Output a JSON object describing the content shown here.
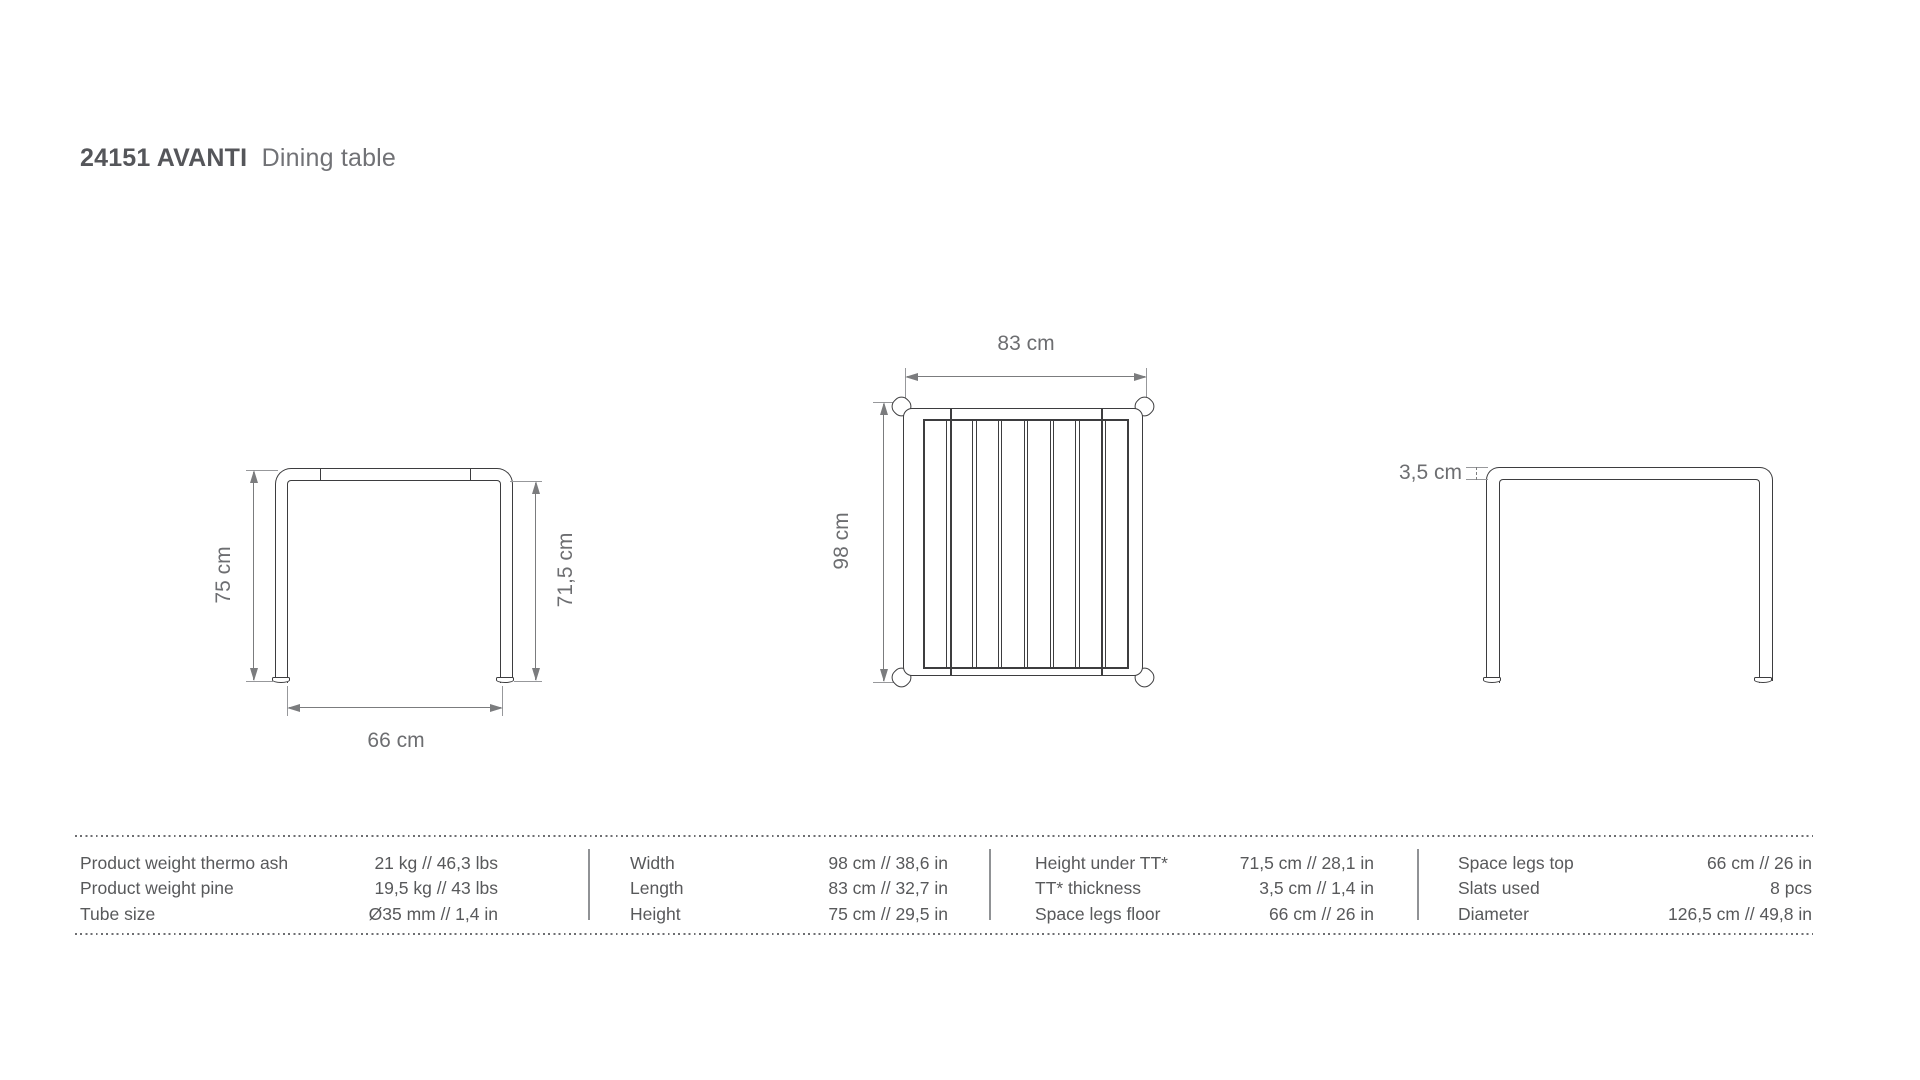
{
  "title": {
    "code": "24151 AVANTI",
    "product_type": "Dining table"
  },
  "drawings": {
    "front_view": {
      "name": "front view",
      "total_height_label": "75 cm",
      "height_under_top_label": "71,5 cm",
      "space_legs_label": "66 cm"
    },
    "top_view": {
      "name": "top view",
      "width_label": "83 cm",
      "length_label": "98 cm",
      "slat_count": 8
    },
    "side_view": {
      "name": "side view",
      "tabletop_thickness_label": "3,5 cm"
    }
  },
  "spec_table": {
    "columns": [
      {
        "rows": [
          {
            "label": "Product weight thermo ash",
            "value": "21 kg // 46,3 lbs"
          },
          {
            "label": "Product weight pine",
            "value": "19,5 kg // 43 lbs"
          },
          {
            "label": "Tube size",
            "value": "Ø35 mm // 1,4 in"
          }
        ]
      },
      {
        "rows": [
          {
            "label": "Width",
            "value": "98 cm // 38,6 in"
          },
          {
            "label": "Length",
            "value": "83 cm // 32,7 in"
          },
          {
            "label": "Height",
            "value": "75 cm // 29,5 in"
          }
        ]
      },
      {
        "rows": [
          {
            "label": "Height under TT*",
            "value": "71,5 cm // 28,1 in"
          },
          {
            "label": "TT* thickness",
            "value": "3,5 cm // 1,4 in"
          },
          {
            "label": "Space legs floor",
            "value": "66 cm // 26 in"
          }
        ]
      },
      {
        "rows": [
          {
            "label": "Space legs top",
            "value": "66 cm // 26 in"
          },
          {
            "label": "Slats used",
            "value": "8 pcs"
          },
          {
            "label": "Diameter",
            "value": "126,5 cm // 49,8 in"
          }
        ]
      }
    ]
  },
  "colors": {
    "drawing_line": "#3d3d3f",
    "dimension_line": "#7b7c7e",
    "text_gray": "#6d6e71",
    "title_dark": "#55565a",
    "background": "#ffffff"
  }
}
